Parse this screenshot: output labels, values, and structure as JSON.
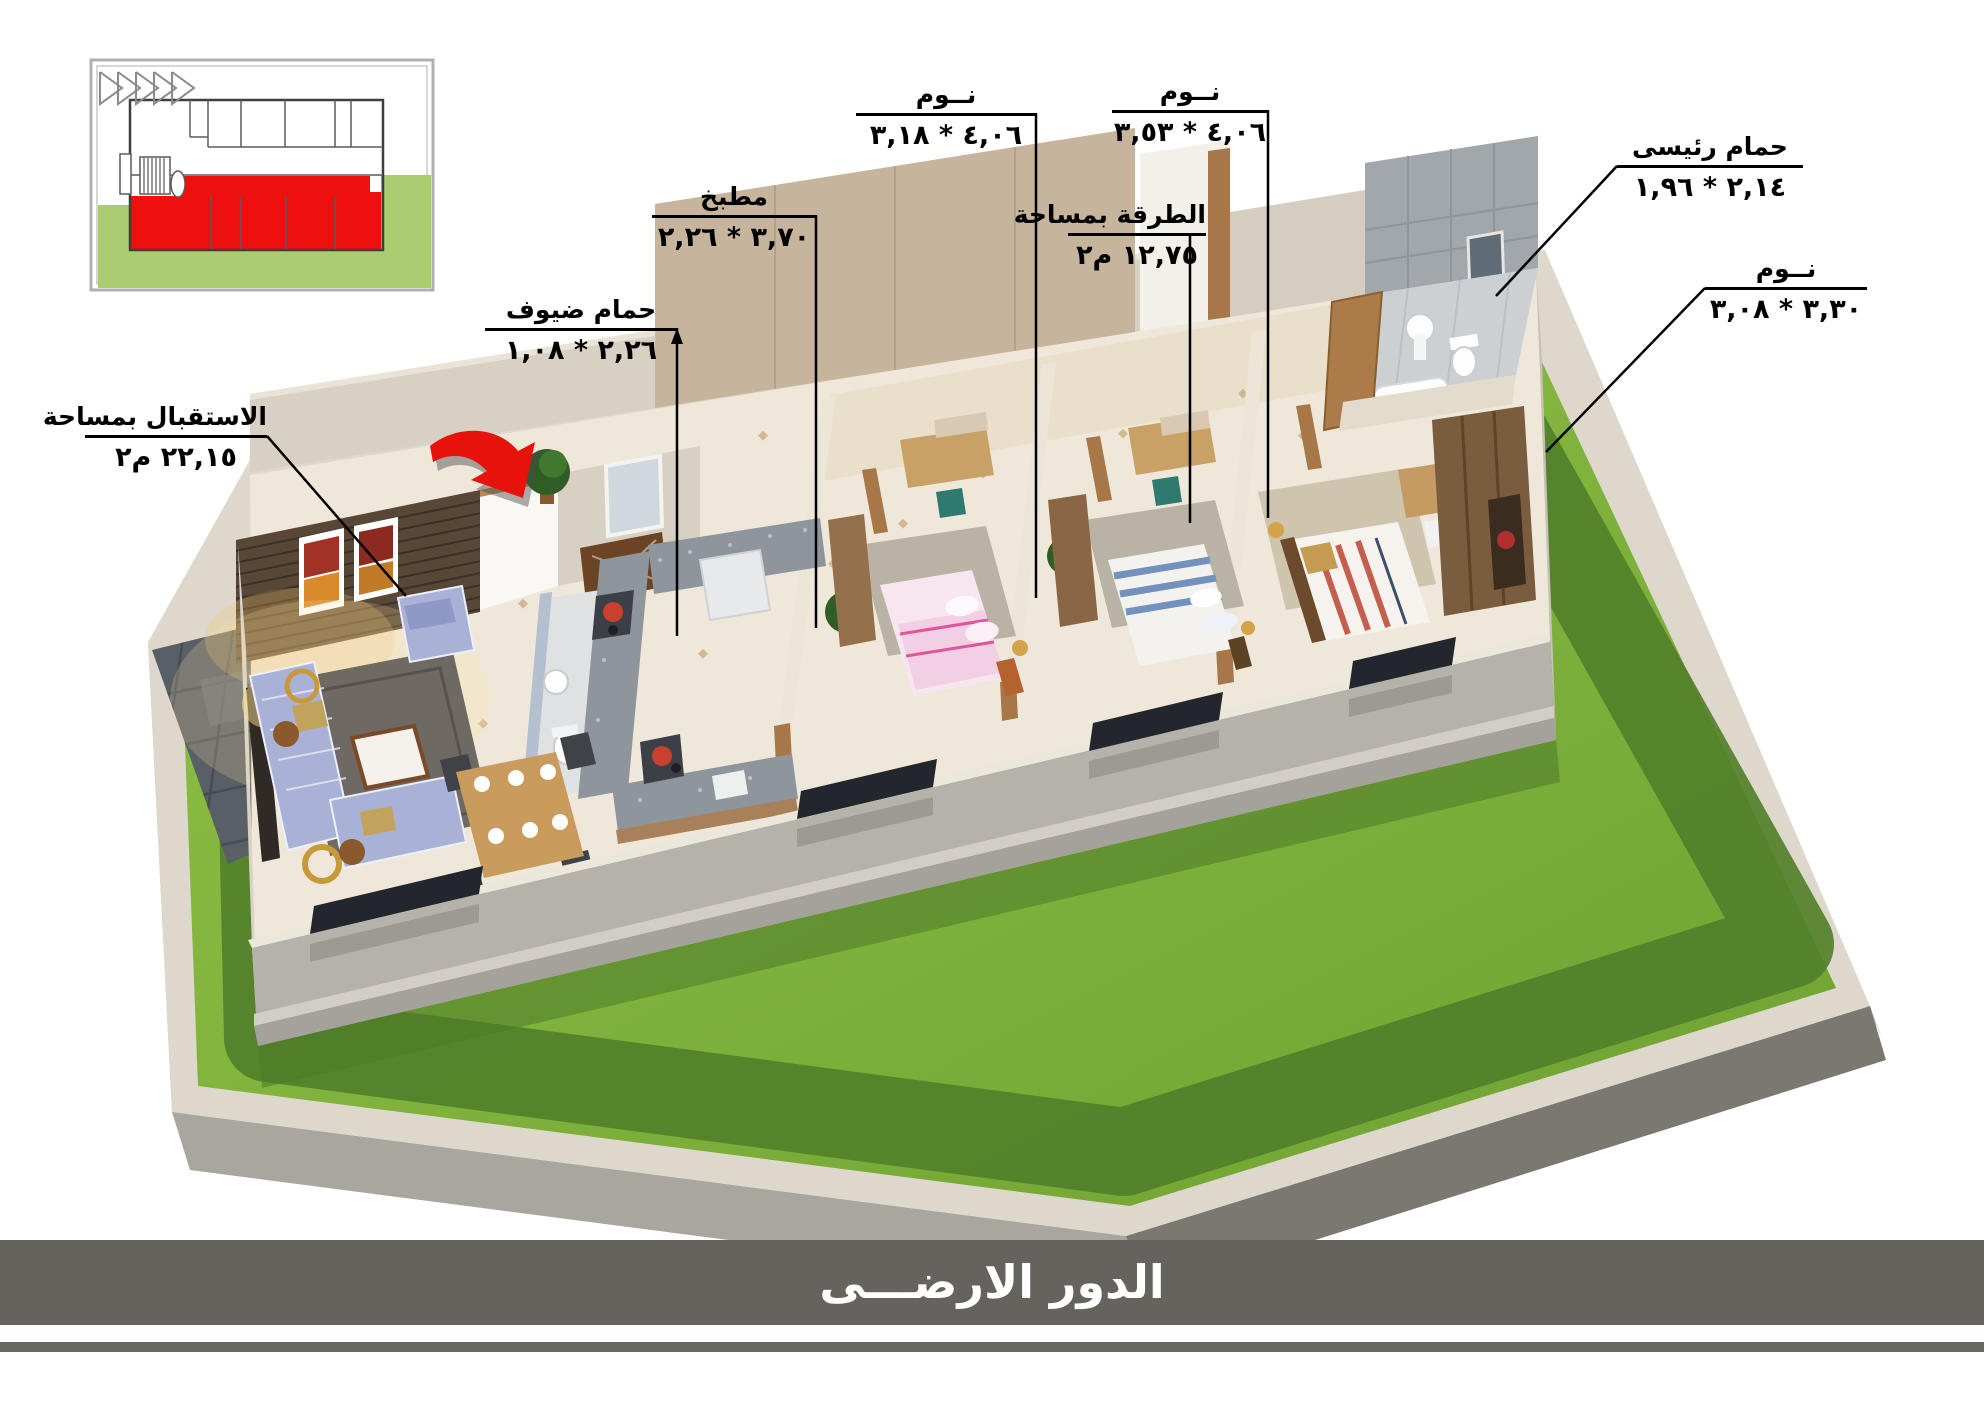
{
  "banner": {
    "text": "الدور الارضـــى",
    "bar_color": "#66635e",
    "text_color": "#ffffff"
  },
  "labels": {
    "reception": {
      "title": "الاستقبال بمساحة",
      "area": "٢٢,١٥ م٢"
    },
    "guest_bathroom": {
      "title": "حمام ضيوف",
      "dimensions": "٢,٢٦ * ١,٠٨"
    },
    "kitchen": {
      "title": "مطبخ",
      "dimensions": "٣,٧٠ * ٢,٢٦"
    },
    "bedroom_left": {
      "title": "نــوم",
      "dimensions": "٤,٠٦ * ٣,١٨"
    },
    "hallway": {
      "title": "الطرقة بمساحة",
      "area": "١٢,٧٥ م٢"
    },
    "bedroom_middle": {
      "title": "نــوم",
      "dimensions": "٤,٠٦ * ٣,٥٣"
    },
    "master_bathroom": {
      "title": "حمام رئيسى",
      "dimensions": "٢,١٤ * ١,٩٦"
    },
    "bedroom_right": {
      "title": "نــوم",
      "dimensions": "٣,٣٠ * ٣,٠٨"
    }
  },
  "palette": {
    "grass": "#7fae3a",
    "grass_shadow": "#52802a",
    "curb": "#ddd8cb",
    "plinth_dark": "#7b7872",
    "front_wall": "#b5b1ab",
    "back_wall": "#d8d1c3",
    "wood_panel": "#c7b49d",
    "stone_wall": "#584737",
    "floor": "#efe8da",
    "arrow_red": "#e8120c",
    "inset_highlight": "#ee0f0f",
    "inset_lawn": "#accd6f"
  }
}
